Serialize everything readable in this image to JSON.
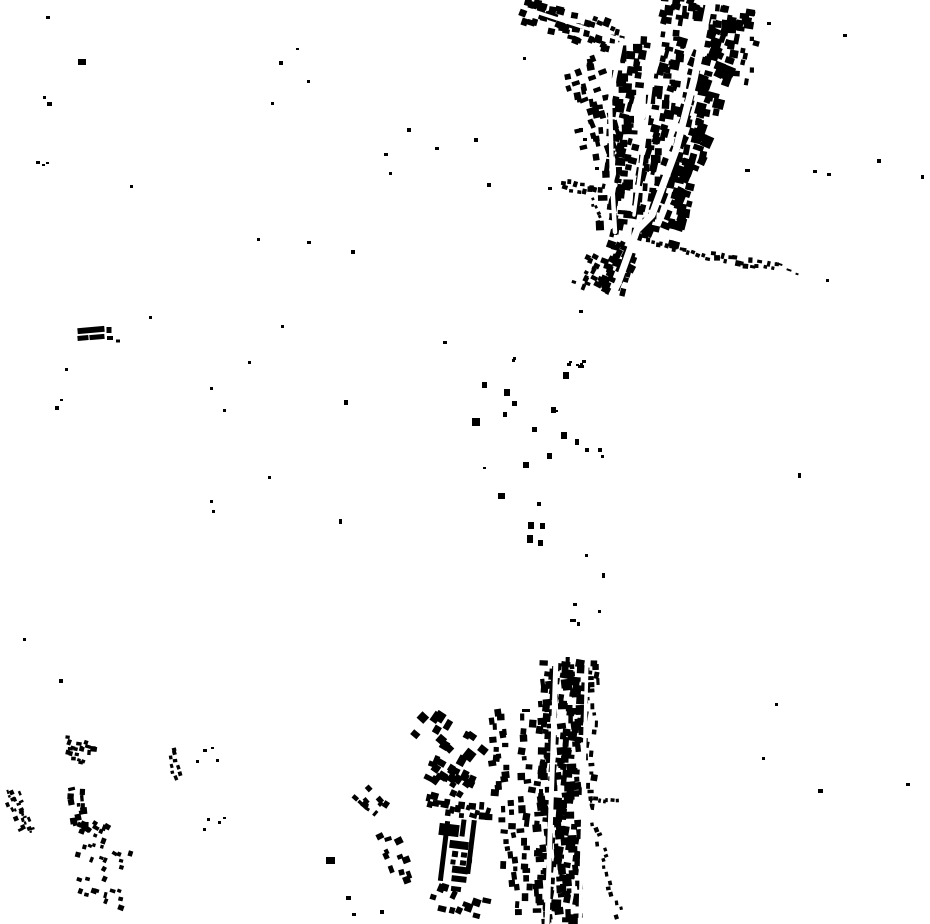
{
  "meta": {
    "type": "building-footprint-map",
    "description": "binary building footprints, black buildings on white ground"
  },
  "map": {
    "width": 930,
    "height": 924,
    "background_color": "#ffffff",
    "building_color": "#000000",
    "road_color": "#ffffff"
  },
  "settlement_strips": [
    {
      "id": "top-arm",
      "line": [
        522,
        12,
        616,
        38
      ],
      "width": 26,
      "count": 48,
      "size": [
        4,
        9
      ],
      "seed": 11
    },
    {
      "id": "top-edge-ne",
      "line": [
        662,
        8,
        752,
        26
      ],
      "width": 28,
      "count": 46,
      "size": [
        4,
        10
      ],
      "seed": 12
    },
    {
      "id": "top-ne-corner",
      "line": [
        750,
        35,
        742,
        85
      ],
      "width": 18,
      "count": 8,
      "size": [
        4,
        8
      ],
      "seed": 13
    },
    {
      "id": "top-east-band",
      "line": [
        722,
        30,
        658,
        242
      ],
      "width": 38,
      "count": 120,
      "size": [
        5,
        12
      ],
      "seed": 14
    },
    {
      "id": "top-mid-band",
      "line": [
        674,
        32,
        638,
        240
      ],
      "width": 24,
      "count": 80,
      "size": [
        4,
        10
      ],
      "seed": 15
    },
    {
      "id": "top-west-band",
      "line": [
        634,
        38,
        612,
        235
      ],
      "width": 28,
      "count": 85,
      "size": [
        4,
        10
      ],
      "seed": 16
    },
    {
      "id": "top-west-fringe",
      "line": [
        580,
        60,
        604,
        160
      ],
      "width": 42,
      "count": 40,
      "size": [
        4,
        9
      ],
      "seed": 17
    },
    {
      "id": "top-tail",
      "line": [
        625,
        245,
        608,
        292
      ],
      "width": 30,
      "count": 38,
      "size": [
        4,
        9
      ],
      "seed": 18
    },
    {
      "id": "top-tail-west",
      "line": [
        592,
        255,
        580,
        288
      ],
      "width": 20,
      "count": 13,
      "size": [
        3,
        7
      ],
      "seed": 19
    },
    {
      "id": "hamlet-row",
      "line": [
        561,
        184,
        604,
        191
      ],
      "width": 11,
      "count": 13,
      "size": [
        3,
        6
      ],
      "seed": 20
    },
    {
      "id": "hamlet-chain",
      "line": [
        592,
        197,
        602,
        228
      ],
      "width": 5,
      "count": 7,
      "size": [
        2,
        4
      ],
      "seed": 21
    },
    {
      "id": "east-chain-west",
      "line": [
        650,
        243,
        710,
        259
      ],
      "width": 6,
      "count": 13,
      "size": [
        3,
        5
      ],
      "seed": 22,
      "layer": "above"
    },
    {
      "id": "east-chain-east",
      "line": [
        712,
        257,
        778,
        267
      ],
      "width": 9,
      "count": 17,
      "size": [
        3,
        6
      ],
      "seed": 23,
      "layer": "above"
    },
    {
      "id": "br-west-column",
      "line": [
        527,
        712,
        523,
        918
      ],
      "width": 14,
      "count": 25,
      "size": [
        4,
        8
      ],
      "seed": 31
    },
    {
      "id": "br-band-west",
      "line": [
        549,
        662,
        543,
        924
      ],
      "width": 18,
      "count": 95,
      "size": [
        4,
        9
      ],
      "seed": 32
    },
    {
      "id": "br-band-east",
      "line": [
        574,
        660,
        566,
        924
      ],
      "width": 26,
      "count": 140,
      "size": [
        4,
        10
      ],
      "seed": 33
    },
    {
      "id": "br-east-fringe",
      "line": [
        592,
        695,
        588,
        808
      ],
      "width": 14,
      "count": 17,
      "size": [
        3,
        7
      ],
      "seed": 34
    },
    {
      "id": "br-ne-corner",
      "line": [
        594,
        663,
        592,
        692
      ],
      "width": 16,
      "count": 10,
      "size": [
        3,
        7
      ],
      "seed": 35
    },
    {
      "id": "br-diag-chain",
      "line": [
        594,
        818,
        620,
        918
      ],
      "width": 8,
      "count": 15,
      "size": [
        3,
        5
      ],
      "seed": 36,
      "layer": "above"
    },
    {
      "id": "br-dash-chain",
      "line": [
        589,
        799,
        618,
        801
      ],
      "width": 3,
      "count": 7,
      "size": [
        2,
        5
      ],
      "seed": 37,
      "layer": "above"
    },
    {
      "id": "bc-north",
      "line": [
        420,
        715,
        478,
        758
      ],
      "width": 44,
      "count": 14,
      "size": [
        6,
        11
      ],
      "seed": 41
    },
    {
      "id": "bc-column",
      "line": [
        497,
        710,
        500,
        795
      ],
      "width": 15,
      "count": 18,
      "size": [
        4,
        8
      ],
      "seed": 42
    },
    {
      "id": "bc-block",
      "line": [
        428,
        768,
        470,
        790
      ],
      "width": 24,
      "count": 22,
      "size": [
        5,
        9
      ],
      "seed": 43
    },
    {
      "id": "bc-block2",
      "line": [
        425,
        803,
        492,
        815
      ],
      "width": 17,
      "count": 20,
      "size": [
        4,
        8
      ],
      "seed": 44
    },
    {
      "id": "bc-west1",
      "line": [
        360,
        792,
        382,
        812
      ],
      "width": 18,
      "count": 11,
      "size": [
        3,
        7
      ],
      "seed": 45
    },
    {
      "id": "bc-west2",
      "line": [
        388,
        832,
        408,
        882
      ],
      "width": 22,
      "count": 11,
      "size": [
        4,
        8
      ],
      "seed": 46
    },
    {
      "id": "bc-right",
      "line": [
        505,
        800,
        510,
        890
      ],
      "width": 14,
      "count": 16,
      "size": [
        4,
        8
      ],
      "seed": 47
    },
    {
      "id": "bc-south",
      "line": [
        430,
        895,
        486,
        914
      ],
      "width": 28,
      "count": 12,
      "size": [
        5,
        9
      ],
      "seed": 48
    },
    {
      "id": "bl-arm1",
      "line": [
        66,
        742,
        96,
        748
      ],
      "width": 12,
      "count": 13,
      "size": [
        3,
        6
      ],
      "seed": 51
    },
    {
      "id": "bl-arm2",
      "line": [
        66,
        756,
        85,
        760
      ],
      "width": 8,
      "count": 7,
      "size": [
        3,
        5
      ],
      "seed": 52
    },
    {
      "id": "bl-vertical",
      "line": [
        76,
        788,
        80,
        830
      ],
      "width": 14,
      "count": 14,
      "size": [
        3,
        7
      ],
      "seed": 53
    },
    {
      "id": "bl-blob",
      "line": [
        80,
        822,
        108,
        836
      ],
      "width": 16,
      "count": 12,
      "size": [
        3,
        7
      ],
      "seed": 54
    },
    {
      "id": "bl-mid",
      "line": [
        80,
        845,
        128,
        865
      ],
      "width": 26,
      "count": 14,
      "size": [
        3,
        6
      ],
      "seed": 55
    },
    {
      "id": "bl-low",
      "line": [
        78,
        880,
        126,
        898
      ],
      "width": 24,
      "count": 13,
      "size": [
        3,
        6
      ],
      "seed": 56
    },
    {
      "id": "bl-right-arm",
      "line": [
        170,
        748,
        178,
        780
      ],
      "width": 12,
      "count": 9,
      "size": [
        3,
        5
      ],
      "seed": 57
    },
    {
      "id": "bl-edge-strip",
      "line": [
        10,
        790,
        28,
        834
      ],
      "width": 18,
      "count": 24,
      "size": [
        2,
        5
      ],
      "seed": 58
    }
  ],
  "roads": [
    {
      "id": "top-main-road",
      "width": 7,
      "points": [
        [
          710,
          0
        ],
        [
          694,
          80
        ],
        [
          676,
          150
        ],
        [
          652,
          215
        ],
        [
          637,
          230
        ],
        [
          618,
          283
        ],
        [
          612,
          295
        ]
      ]
    },
    {
      "id": "top-left-street",
      "width": 4.5,
      "points": [
        [
          622,
          40
        ],
        [
          610,
          100
        ],
        [
          612,
          180
        ],
        [
          615,
          232
        ]
      ]
    },
    {
      "id": "top-mid-street",
      "width": 3.5,
      "points": [
        [
          655,
          55
        ],
        [
          643,
          150
        ],
        [
          634,
          215
        ]
      ]
    },
    {
      "id": "top-arm-road",
      "width": 3.5,
      "points": [
        [
          518,
          6
        ],
        [
          622,
          40
        ]
      ]
    },
    {
      "id": "east-chain-road",
      "width": 3,
      "points": [
        [
          650,
          245
        ],
        [
          708,
          258
        ],
        [
          750,
          263
        ],
        [
          792,
          270
        ]
      ]
    },
    {
      "id": "br-main-road",
      "width": 5,
      "points": [
        [
          556,
          658
        ],
        [
          547,
          924
        ]
      ]
    },
    {
      "id": "br-east-street",
      "width": 3.5,
      "points": [
        [
          587,
          658
        ],
        [
          580,
          924
        ]
      ]
    },
    {
      "id": "br-diagonal-road",
      "width": 3,
      "points": [
        [
          588,
          805
        ],
        [
          622,
          924
        ]
      ]
    }
  ],
  "structures": [
    {
      "id": "barracks-bar-1",
      "x": 91,
      "y": 330,
      "w": 27,
      "h": 6,
      "rot": -5
    },
    {
      "id": "barracks-bar-2",
      "x": 83,
      "y": 338,
      "w": 11,
      "h": 5,
      "rot": -5
    },
    {
      "id": "barracks-bar-3",
      "x": 97,
      "y": 337,
      "w": 15,
      "h": 5,
      "rot": -5
    },
    {
      "id": "barracks-square-1",
      "x": 109,
      "y": 330,
      "w": 5,
      "h": 6,
      "rot": 0
    },
    {
      "id": "barracks-square-2",
      "x": 110,
      "y": 338,
      "w": 6,
      "h": 4,
      "rot": 0
    },
    {
      "id": "barracks-square-3",
      "x": 118,
      "y": 341,
      "w": 4,
      "h": 3,
      "rot": 0
    },
    {
      "id": "compound-left-wall",
      "x": 444,
      "y": 851,
      "w": 5,
      "h": 60,
      "rot": 7
    },
    {
      "id": "compound-right-wall",
      "x": 471,
      "y": 847,
      "w": 5,
      "h": 54,
      "rot": 7
    },
    {
      "id": "compound-top-block",
      "x": 449,
      "y": 830,
      "w": 20,
      "h": 12,
      "rot": 7
    },
    {
      "id": "compound-top-bar",
      "x": 463,
      "y": 828,
      "w": 5,
      "h": 17,
      "rot": 7
    },
    {
      "id": "compound-inner-bar",
      "x": 459,
      "y": 845,
      "w": 19,
      "h": 8,
      "rot": 7
    },
    {
      "id": "compound-inner-1",
      "x": 455,
      "y": 854,
      "w": 6,
      "h": 6,
      "rot": 7
    },
    {
      "id": "compound-inner-2",
      "x": 464,
      "y": 855,
      "w": 6,
      "h": 5,
      "rot": 7
    },
    {
      "id": "compound-inner-3",
      "x": 453,
      "y": 862,
      "w": 5,
      "h": 5,
      "rot": 7
    },
    {
      "id": "compound-inner-4",
      "x": 463,
      "y": 863,
      "w": 6,
      "h": 5,
      "rot": 7
    },
    {
      "id": "compound-inner-5",
      "x": 470,
      "y": 861,
      "w": 4,
      "h": 4,
      "rot": 7
    },
    {
      "id": "compound-lower-bar",
      "x": 460,
      "y": 870,
      "w": 16,
      "h": 7,
      "rot": 7
    },
    {
      "id": "compound-bottom-bar",
      "x": 459,
      "y": 879,
      "w": 15,
      "h": 6,
      "rot": 7
    },
    {
      "id": "compound-south-bar",
      "x": 456,
      "y": 889,
      "w": 10,
      "h": 5,
      "rot": 7
    },
    {
      "id": "chain-tail-dash-1",
      "x": 779,
      "y": 264,
      "w": 7,
      "h": 2,
      "rot": 18
    },
    {
      "id": "chain-tail-dash-2",
      "x": 789,
      "y": 270,
      "w": 5,
      "h": 2,
      "rot": 18
    },
    {
      "id": "chain-tail-dash-3",
      "x": 797,
      "y": 274,
      "w": 3,
      "h": 2,
      "rot": 18
    }
  ],
  "middle_hamlet_buildings": [
    [
      512,
      359,
      3,
      3
    ],
    [
      567,
      363,
      4,
      3
    ],
    [
      576,
      364,
      3,
      2
    ],
    [
      580,
      363,
      3,
      2
    ],
    [
      563,
      372,
      6,
      7
    ],
    [
      482,
      382,
      5,
      6
    ],
    [
      504,
      389,
      6,
      7
    ],
    [
      512,
      401,
      5,
      5
    ],
    [
      503,
      412,
      4,
      5
    ],
    [
      551,
      407,
      5,
      6
    ],
    [
      556,
      410,
      2,
      2
    ],
    [
      472,
      418,
      8,
      8
    ],
    [
      532,
      427,
      5,
      5
    ],
    [
      561,
      432,
      6,
      7
    ],
    [
      575,
      439,
      4,
      6
    ],
    [
      585,
      448,
      4,
      4
    ],
    [
      598,
      448,
      4,
      4
    ],
    [
      601,
      455,
      3,
      3
    ],
    [
      547,
      453,
      5,
      6
    ],
    [
      523,
      462,
      6,
      6
    ],
    [
      483,
      467,
      3,
      2
    ],
    [
      498,
      493,
      7,
      6
    ],
    [
      537,
      502,
      4,
      4
    ],
    [
      528,
      522,
      6,
      7
    ],
    [
      540,
      523,
      5,
      6
    ],
    [
      527,
      535,
      6,
      8
    ],
    [
      538,
      540,
      5,
      6
    ],
    [
      585,
      554,
      3,
      3
    ]
  ],
  "isolated_buildings": [
    [
      46,
      16,
      4,
      3
    ],
    [
      78,
      59,
      8,
      6
    ],
    [
      43,
      96,
      3,
      3
    ],
    [
      47,
      102,
      5,
      4
    ],
    [
      36,
      161,
      4,
      3
    ],
    [
      42,
      164,
      3,
      2
    ],
    [
      46,
      162,
      3,
      2
    ],
    [
      130,
      185,
      3,
      3
    ],
    [
      296,
      48,
      3,
      2
    ],
    [
      279,
      61,
      4,
      4
    ],
    [
      271,
      102,
      3,
      3
    ],
    [
      257,
      238,
      3,
      3
    ],
    [
      307,
      80,
      3,
      3
    ],
    [
      307,
      241,
      4,
      3
    ],
    [
      351,
      250,
      4,
      4
    ],
    [
      384,
      153,
      4,
      3
    ],
    [
      389,
      172,
      3,
      3
    ],
    [
      407,
      128,
      4,
      4
    ],
    [
      435,
      147,
      4,
      3
    ],
    [
      474,
      138,
      4,
      4
    ],
    [
      487,
      183,
      4,
      4
    ],
    [
      548,
      187,
      4,
      3
    ],
    [
      579,
      128,
      4,
      4
    ],
    [
      583,
      138,
      4,
      3
    ],
    [
      595,
      167,
      4,
      3
    ],
    [
      523,
      57,
      3,
      3
    ],
    [
      513,
      357,
      3,
      3
    ],
    [
      443,
      341,
      4,
      3
    ],
    [
      579,
      310,
      4,
      3
    ],
    [
      767,
      22,
      4,
      3
    ],
    [
      843,
      34,
      4,
      3
    ],
    [
      877,
      159,
      4,
      4
    ],
    [
      745,
      169,
      5,
      3
    ],
    [
      813,
      170,
      4,
      3
    ],
    [
      827,
      173,
      4,
      3
    ],
    [
      921,
      175,
      3,
      4
    ],
    [
      826,
      279,
      3,
      3
    ],
    [
      149,
      316,
      3,
      3
    ],
    [
      281,
      325,
      3,
      3
    ],
    [
      65,
      368,
      3,
      3
    ],
    [
      60,
      399,
      3,
      2
    ],
    [
      55,
      406,
      4,
      4
    ],
    [
      248,
      361,
      3,
      3
    ],
    [
      210,
      387,
      3,
      3
    ],
    [
      223,
      409,
      3,
      3
    ],
    [
      344,
      400,
      4,
      5
    ],
    [
      268,
      476,
      3,
      3
    ],
    [
      210,
      500,
      3,
      3
    ],
    [
      212,
      510,
      3,
      3
    ],
    [
      339,
      519,
      3,
      5
    ],
    [
      23,
      638,
      3,
      3
    ],
    [
      59,
      679,
      4,
      4
    ],
    [
      798,
      473,
      3,
      5
    ],
    [
      569,
      361,
      3,
      2
    ],
    [
      582,
      360,
      4,
      3
    ],
    [
      578,
      365,
      6,
      3
    ],
    [
      602,
      573,
      3,
      5
    ],
    [
      573,
      603,
      4,
      3
    ],
    [
      598,
      610,
      3,
      3
    ],
    [
      570,
      619,
      6,
      3
    ],
    [
      577,
      622,
      3,
      4
    ],
    [
      203,
      749,
      4,
      3
    ],
    [
      211,
      747,
      3,
      2
    ],
    [
      216,
      759,
      3,
      3
    ],
    [
      196,
      760,
      3,
      3
    ],
    [
      207,
      818,
      3,
      3
    ],
    [
      218,
      821,
      3,
      3
    ],
    [
      223,
      817,
      3,
      2
    ],
    [
      203,
      828,
      3,
      3
    ],
    [
      326,
      857,
      9,
      7
    ],
    [
      346,
      896,
      5,
      4
    ],
    [
      380,
      910,
      4,
      4
    ],
    [
      352,
      913,
      4,
      3
    ],
    [
      775,
      703,
      3,
      3
    ],
    [
      762,
      757,
      3,
      3
    ],
    [
      818,
      789,
      5,
      4
    ],
    [
      906,
      783,
      4,
      3
    ],
    [
      522,
      709,
      8,
      3
    ]
  ]
}
